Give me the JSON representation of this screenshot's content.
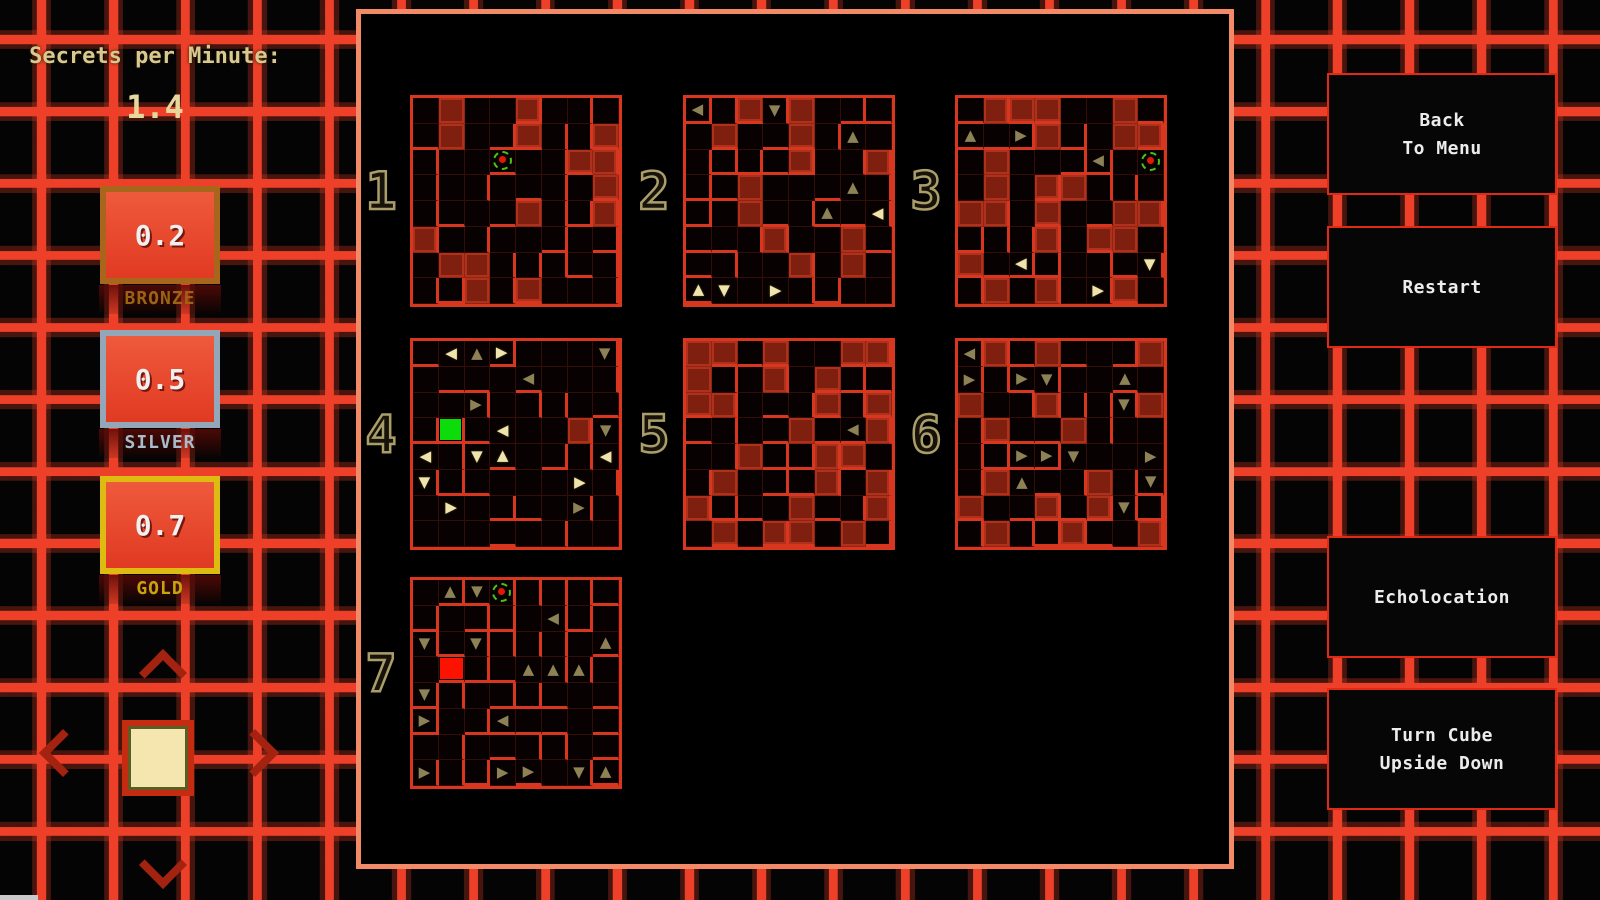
{
  "hud": {
    "secrets_label": "Secrets per Minute:",
    "secrets_value": "1.4",
    "medals": [
      {
        "value": "0.2",
        "label": "BRONZE",
        "frame_color": "#a8651c",
        "label_color": "#9c6314"
      },
      {
        "value": "0.5",
        "label": "SILVER",
        "frame_color": "#93a7b9",
        "label_color": "#aabccb"
      },
      {
        "value": "0.7",
        "label": "GOLD",
        "frame_color": "#ddbb10",
        "label_color": "#c7a40b"
      }
    ],
    "nav": {
      "up_icon": "up-chevron",
      "down_icon": "down-chevron",
      "left_icon": "left-chevron",
      "right_icon": "right-chevron",
      "center_icon": "current-face-square"
    }
  },
  "buttons": [
    {
      "id": "back-to-menu",
      "lines": [
        "Back",
        "To Menu"
      ]
    },
    {
      "id": "restart",
      "lines": [
        "Restart"
      ]
    },
    {
      "id": "echolocation",
      "lines": [
        "Echolocation"
      ]
    },
    {
      "id": "turn-cube-upside-down",
      "lines": [
        "Turn Cube",
        "Upside Down"
      ]
    }
  ],
  "cell_legend": {
    "#": "filled-dark-red-cell",
    ".": "empty-cell",
    "u/d/l/r": "olive-arrow up/down/left/right",
    "U/D/L/R": "cream-arrow up/down/left/right",
    "G": "green-highlight-cell",
    "X": "red-highlight-cell",
    "P": "player-marker (red dot in dashed green ring)"
  },
  "mazes": [
    {
      "number": "1",
      "cells": [
        ".#..#...",
        ".#..#..#",
        "...P..##",
        ".......#",
        "....#..#",
        "#.......",
        ".##.....",
        "..#.#..."
      ]
    },
    {
      "number": "2",
      "cells": [
        "l.#d#...",
        ".#..#.u.",
        "....#..#",
        "..#...u.",
        "..#..u.L",
        "...#..#.",
        "....#.#.",
        "UD.R...."
      ]
    },
    {
      "number": "3",
      "cells": [
        ".###..#.",
        "u.r#..##",
        ".#...l.P",
        ".#.##...",
        "##.#..##",
        "...#.##.",
        "#.L....D",
        ".#.#.R#."
      ]
    },
    {
      "number": "4",
      "cells": [
        ".LuR...d",
        "....l...",
        "..r.....",
        ".G.L..#d",
        "L.DU...L",
        "D.....R.",
        ".R....r.",
        "........"
      ]
    },
    {
      "number": "5",
      "cells": [
        "##.#..##",
        "#..#.#..",
        "##...#.#",
        "....#.l#",
        "..#..##.",
        ".#...#.#",
        "#...#..#",
        ".#.##.#."
      ]
    },
    {
      "number": "6",
      "cells": [
        "l#.#...#",
        "r.rd..u.",
        "#..#..d#",
        ".#..#...",
        "..rrd..r",
        ".#u..#.d",
        "#..#.#d.",
        ".#..#..#"
      ]
    },
    {
      "number": "7",
      "cells": [
        ".udP....",
        ".....l..",
        "d.d....u",
        ".X..uuu.",
        "d.......",
        "r..l....",
        "........",
        "r..rr.du"
      ]
    }
  ],
  "colors": {
    "grid_line": "#ee4028",
    "panel_border": "#f28a68",
    "maze_wall": "#d93620",
    "maze_fill": "#7e1f10",
    "arrow_olive": "#8d8156",
    "arrow_cream": "#f0e4ae",
    "marker_ring_green": "#49c414",
    "marker_dot_red": "#e01808",
    "green_square": "#0cdd0a",
    "red_square": "#fb1200",
    "hud_text_tan": "#d8c98f",
    "maze_number_tan": "#a99d6a",
    "medal_fill_red": "#e04a2e",
    "button_border": "#e02a16",
    "button_text": "#ececec"
  }
}
